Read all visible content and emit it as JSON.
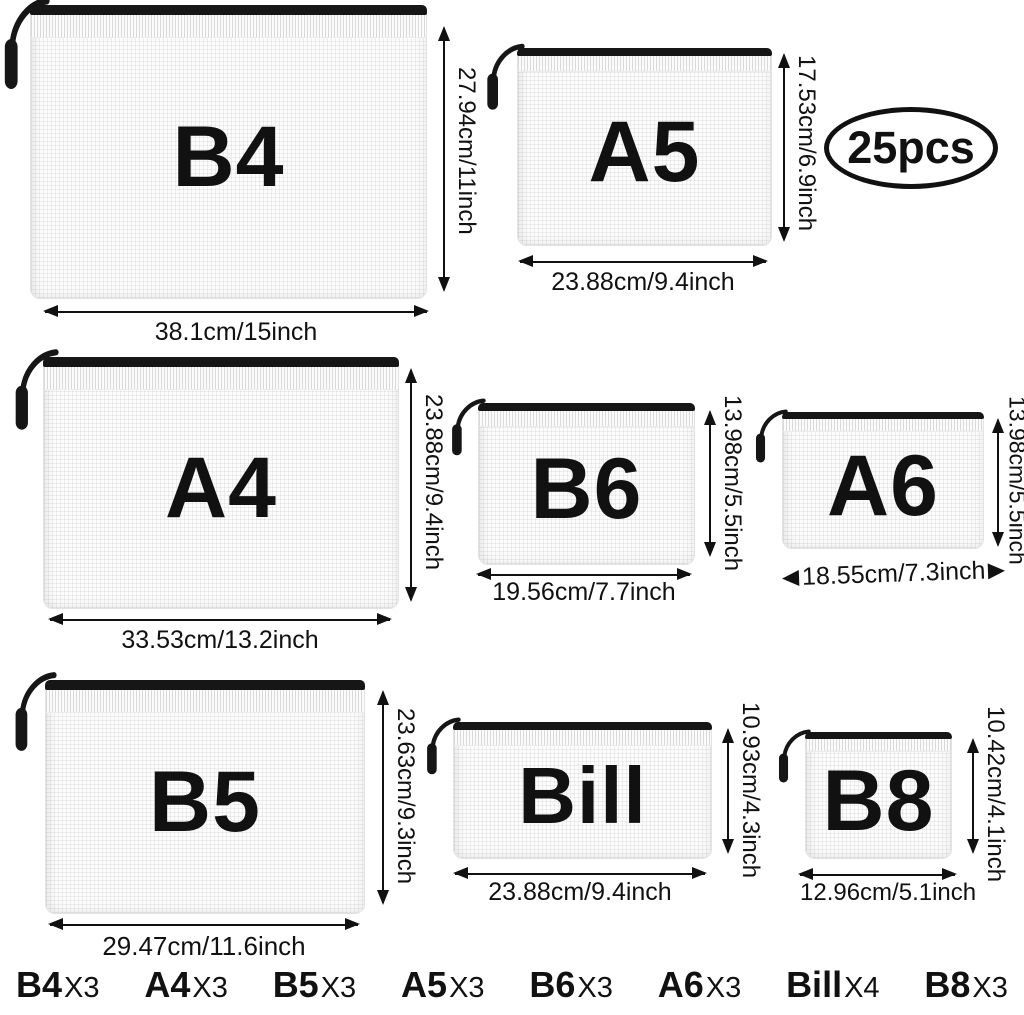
{
  "badge": {
    "label": "25pcs"
  },
  "pouches": [
    {
      "label": "B4",
      "height_dim": "27.94cm/11inch",
      "width_dim": "38.1cm/15inch"
    },
    {
      "label": "A5",
      "height_dim": "17.53cm/6.9inch",
      "width_dim": "23.88cm/9.4inch"
    },
    {
      "label": "A4",
      "height_dim": "23.88cm/9.4inch",
      "width_dim": "33.53cm/13.2inch"
    },
    {
      "label": "B6",
      "height_dim": "13.98cm/5.5inch",
      "width_dim": "19.56cm/7.7inch"
    },
    {
      "label": "A6",
      "height_dim": "13.98cm/5.5inch",
      "width_dim": "18.55cm/7.3inch"
    },
    {
      "label": "B5",
      "height_dim": "23.63cm/9.3inch",
      "width_dim": "29.47cm/11.6inch"
    },
    {
      "label": "Bill",
      "height_dim": "10.93cm/4.3inch",
      "width_dim": "23.88cm/9.4inch"
    },
    {
      "label": "B8",
      "height_dim": "10.42cm/4.1inch",
      "width_dim": "12.96cm/5.1inch"
    }
  ],
  "quantities": [
    {
      "name": "B4",
      "count": "X3"
    },
    {
      "name": "A4",
      "count": "X3"
    },
    {
      "name": "B5",
      "count": "X3"
    },
    {
      "name": "A5",
      "count": "X3"
    },
    {
      "name": "B6",
      "count": "X3"
    },
    {
      "name": "A6",
      "count": "X3"
    },
    {
      "name": "Bill",
      "count": "X4"
    },
    {
      "name": "B8",
      "count": "X3"
    }
  ],
  "colors": {
    "ink": "#111111",
    "zipper": "#161616",
    "pouch": "#fcfcfc",
    "background": "#ffffff"
  }
}
